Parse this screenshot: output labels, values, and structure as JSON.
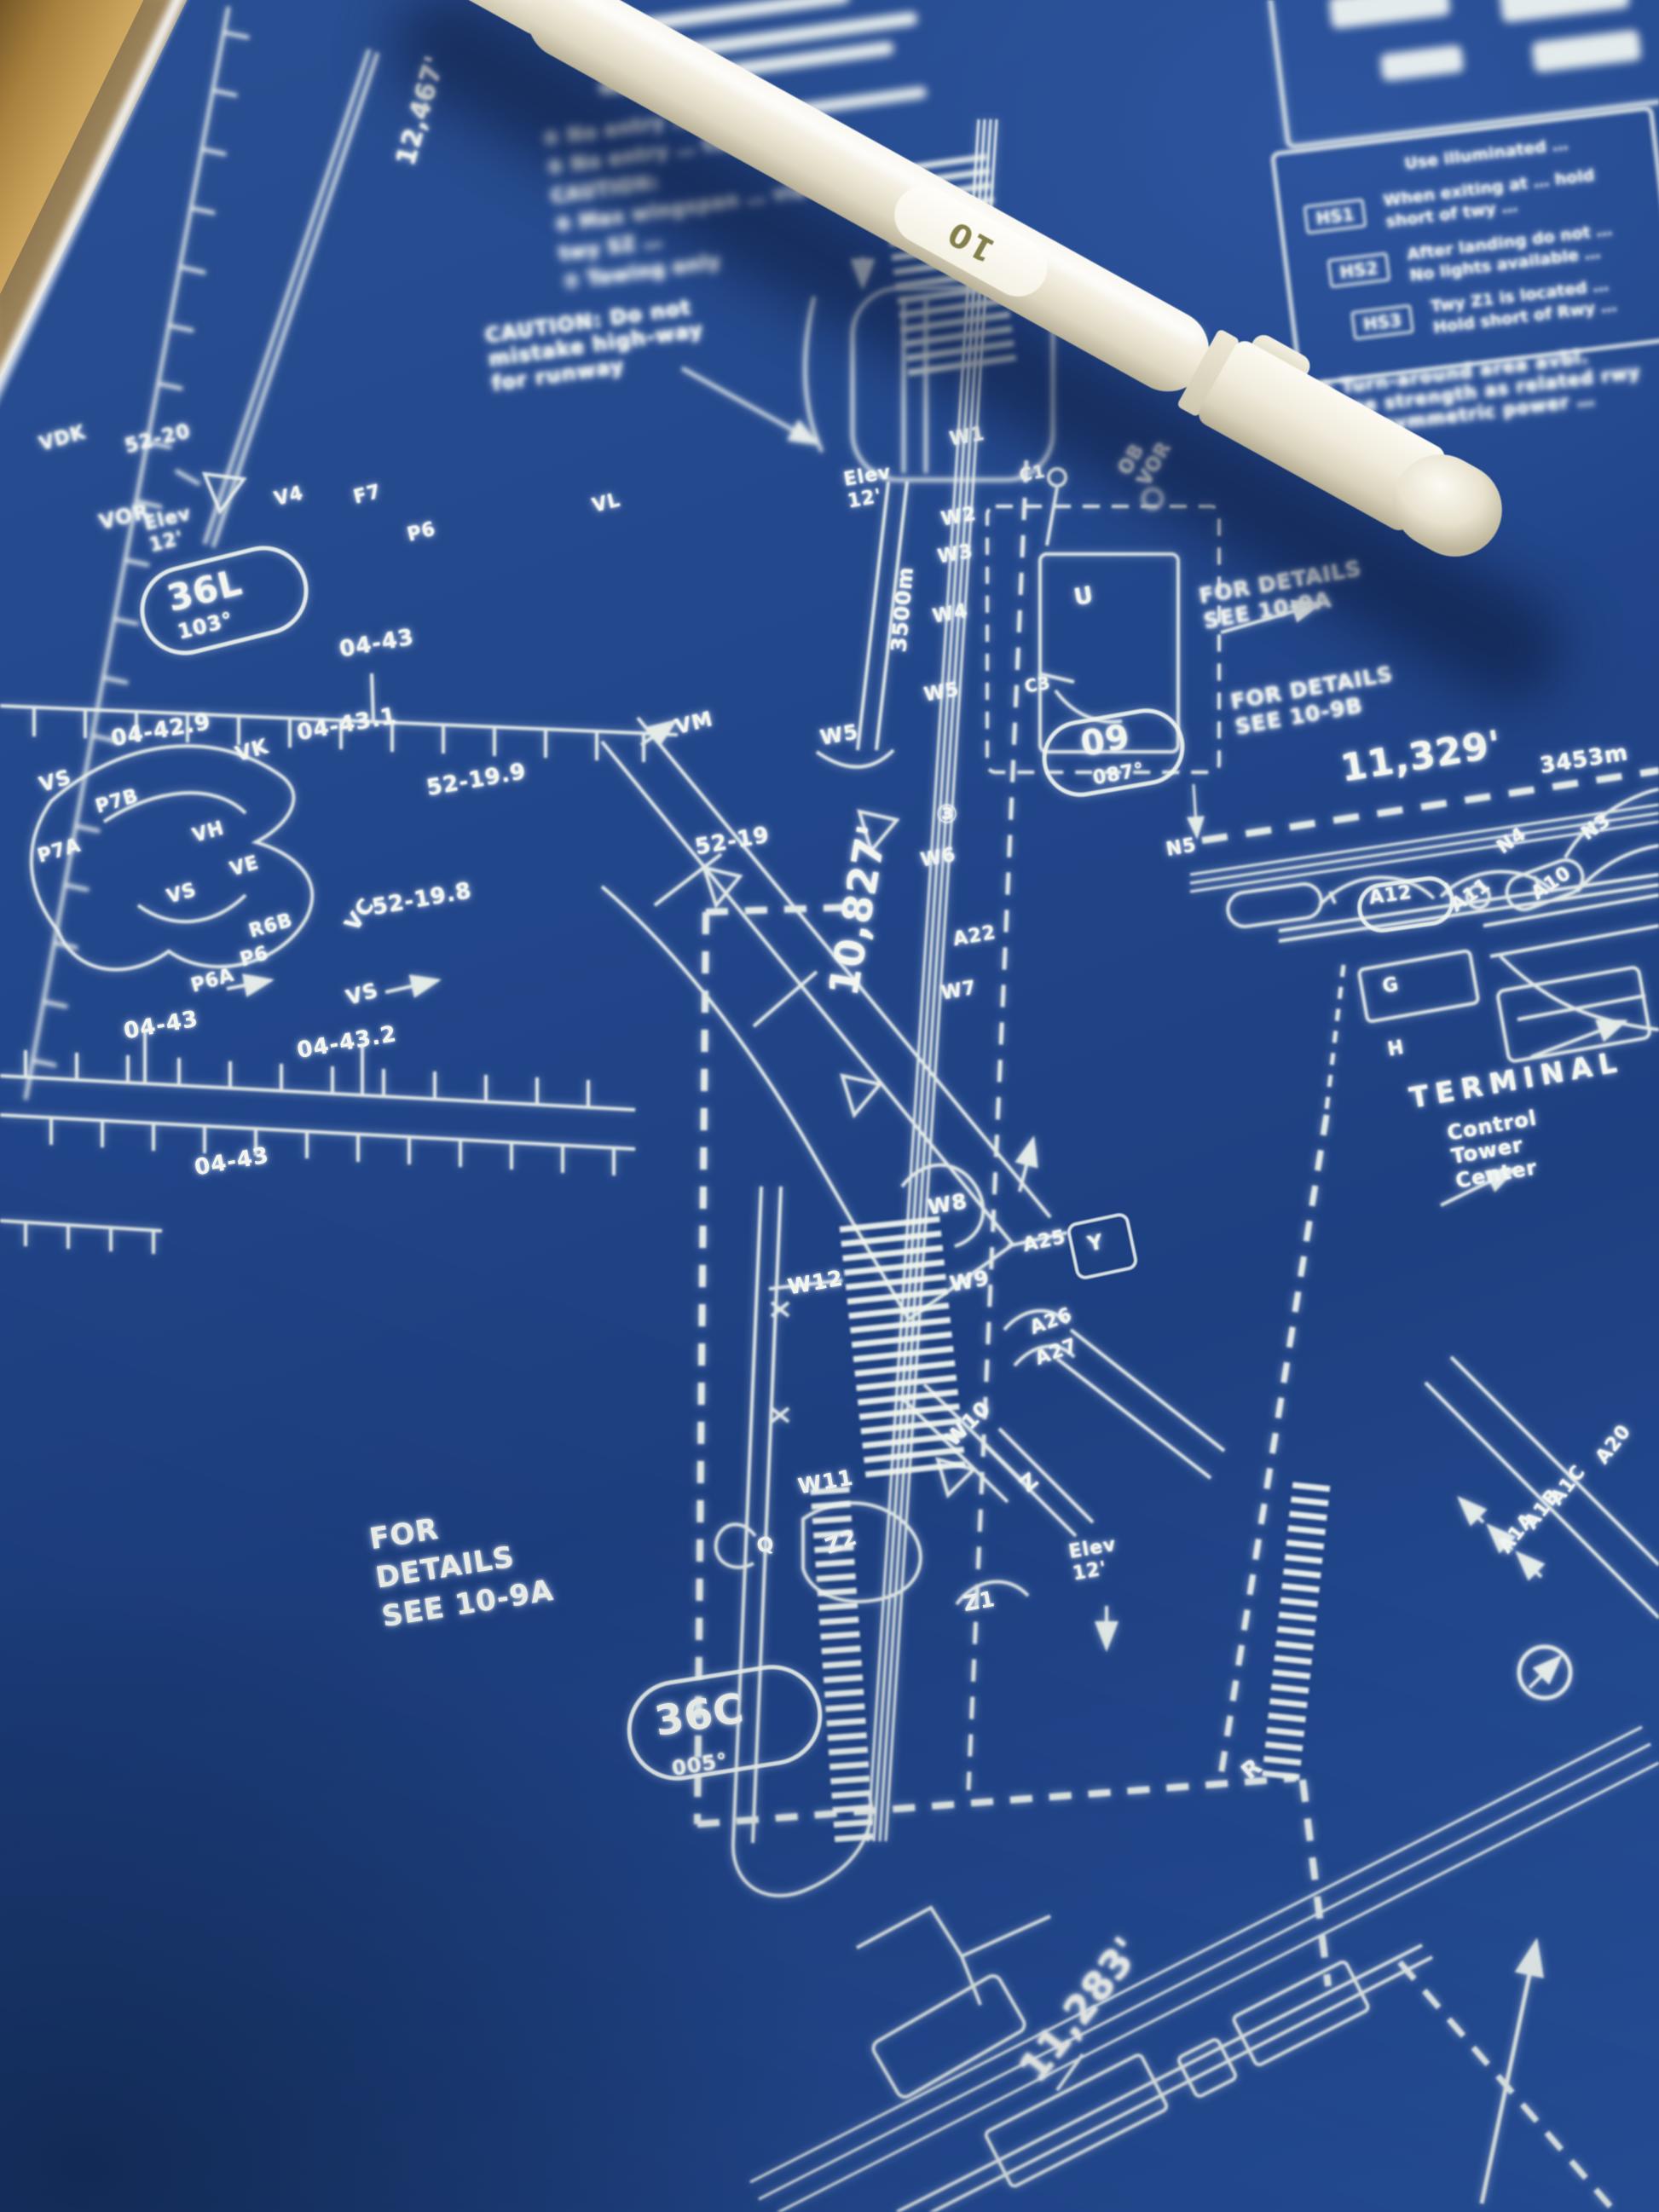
{
  "colors": {
    "blueprint_blue": "#21468a",
    "line_white": "#eef3ec",
    "wood_tan": "#d9b269",
    "pen_white": "#efebdd",
    "pen_marking_olive": "#84804e"
  },
  "pen": {
    "marking": "10"
  },
  "runways": {
    "r36l": "36L",
    "r36l_hdg": "103°",
    "r36c": "36C",
    "r36c_hdg": "005°",
    "r09": "09",
    "r09_hdg": "087°",
    "len_12467": "12,467'",
    "len_10827": "10,827'",
    "len_11329": "11,329'",
    "len_11329_m": "3453m",
    "len_11283": "11,283'",
    "len_3500m": "3500m",
    "elev_12_left": "Elev\n12'",
    "elev_12_mid": "Elev\n12'",
    "elev_12_bottom": "Elev\n12'"
  },
  "grid": {
    "g52_20": "52-20",
    "g52_19_9": "52-19.9",
    "g52_19_8": "52-19.8",
    "g52_19": "52-19",
    "g04_43_top": "04-43",
    "g04_42_9": "04-42.9",
    "g04_43_1": "04-43.1",
    "g04_43_mid": "04-43",
    "g04_43_2": "04-43.2",
    "g04_43_bottom": "04-43"
  },
  "navaids": {
    "vor_left": "VOR",
    "vor_rwy": "OB\nVOR"
  },
  "taxiways": {
    "vdk": "VDK",
    "v4": "V4",
    "f7": "F7",
    "p6_top": "P6",
    "vl": "VL",
    "vk": "VK",
    "vm": "VM",
    "vs_a": "VS",
    "vs_b": "VS",
    "vs_c": "VS",
    "p7a": "P7A",
    "p7b": "P7B",
    "vh": "VH",
    "ve": "VE",
    "r6b": "R6B",
    "p6": "P6",
    "p6a": "P6A",
    "vc": "VC",
    "w1": "W1",
    "w2": "W2",
    "w3": "W3",
    "w4": "W4",
    "w5": "W5",
    "w5b": "W5",
    "w6": "W6",
    "w7": "W7",
    "w8": "W8",
    "w9": "W9",
    "w10": "W10",
    "w11": "W11",
    "w12": "W12",
    "c1": "C1",
    "c3": "C3",
    "u": "U",
    "n3": "N3",
    "n4": "N4",
    "n5": "N5",
    "a10": "A10",
    "a11": "A11",
    "a12": "A12",
    "a20": "A20",
    "a22": "A22",
    "a25": "A25",
    "a26": "A26",
    "a27": "A27",
    "a1a": "A1A",
    "a1b": "A1B",
    "a1c": "A1C",
    "g": "G",
    "h": "H",
    "y": "Y",
    "z": "Z",
    "z1": "Z1",
    "z2": "Z2",
    "q": "Q",
    "r": "R",
    "spot3": "③"
  },
  "notes": {
    "caution_highway": "CAUTION: Do not\nmistake high-way\nfor runway",
    "numbered_items": "④ No entry … twy …\n⑤ No entry … twy Z …\nCAUTION:\n⑥ Max wingspan … via\n    twy SZ …\n⑦ Towing only",
    "details_right_a": "FOR DETAILS\nSEE 10-9A",
    "details_right_b": "FOR DETAILS\nSEE 10-9B",
    "details_left": "FOR\nDETAILS\nSEE 10-9A",
    "terminal": "TERMINAL",
    "control_tower": "Control\nTower\nCenter",
    "turnaround": "⑤ Turn-around area avbl.\nsame strength as related rwy\nand asymmetric power …"
  },
  "hotspots": {
    "header": "Use illuminated …",
    "hs1": "HS1",
    "hs1_text": "When exiting at … hold\nshort of twy …",
    "hs2": "HS2",
    "hs2_text": "After landing do not …\nNo lights available …",
    "hs3": "HS3",
    "hs3_text": "Twy Z1 is located …\nHold short of Rwy …"
  }
}
